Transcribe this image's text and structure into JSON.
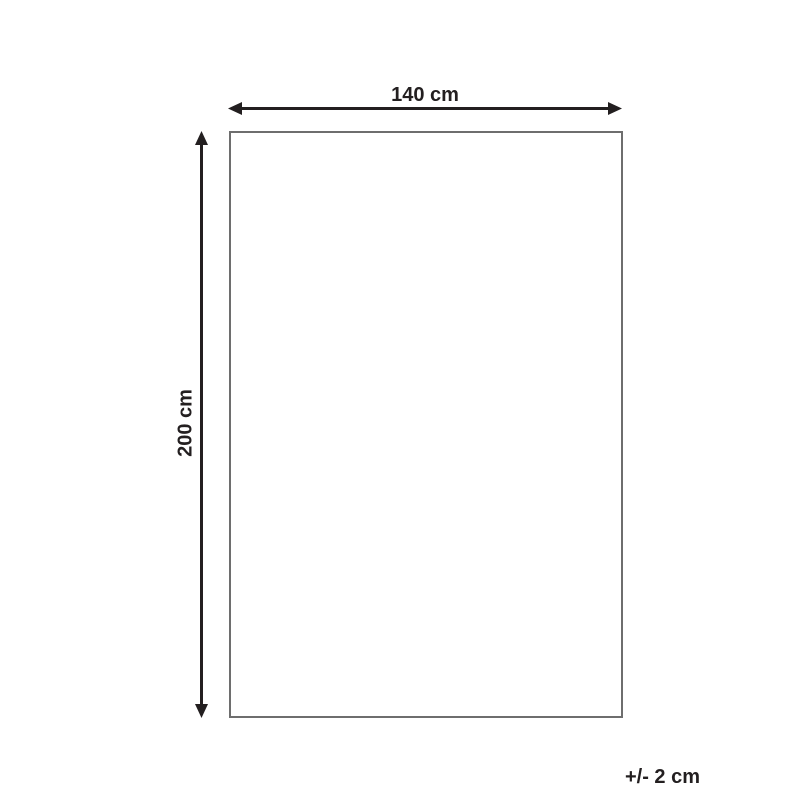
{
  "diagram": {
    "width_label": "140 cm",
    "height_label": "200 cm",
    "tolerance_label": "+/- 2 cm"
  },
  "icons": {
    "horizontal_arrow": "double-headed-horizontal-dimension-arrow",
    "vertical_arrow": "double-headed-vertical-dimension-arrow"
  },
  "colors": {
    "background": "#ffffff",
    "arrow": "#231f20",
    "text": "#231f20",
    "outline": "#6e6e6e"
  }
}
